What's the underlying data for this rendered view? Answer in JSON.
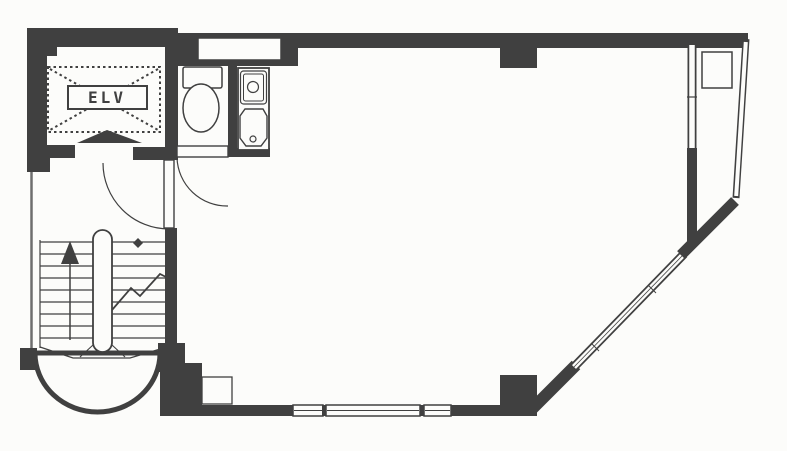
{
  "title": "Building floor plan",
  "labels": {
    "elevator": "ELV"
  },
  "colors": {
    "wall": "#404040",
    "mid": "#6e6e6e",
    "white": "#fcfcfa",
    "none": "none"
  },
  "canvas": {
    "width": 787,
    "height": 451
  },
  "shapes": [
    {
      "t": "path",
      "n": "stair-bay-wall",
      "d": "M35,353 A62.5,59 0 0 0 160,353 Z",
      "f": "white",
      "s": "wall",
      "sw": 5
    },
    {
      "t": "line",
      "n": "left-exterior-wall",
      "x1": 31.5,
      "y1": 150,
      "x2": 31.5,
      "y2": 352,
      "s": "mid",
      "sw": 2.5
    },
    {
      "t": "rect",
      "n": "top-wall-elevator",
      "x": 27,
      "y": 28,
      "w": 151,
      "h": 19,
      "f": "wall"
    },
    {
      "t": "rect",
      "n": "top-wall-main",
      "x": 178,
      "y": 33,
      "w": 570,
      "h": 15,
      "f": "wall"
    },
    {
      "t": "rect",
      "n": "wc-ceiling-wall",
      "x": 175,
      "y": 33,
      "w": 123,
      "h": 33,
      "f": "wall"
    },
    {
      "t": "rect",
      "n": "top-window",
      "x": 198,
      "y": 38,
      "w": 83,
      "h": 22,
      "f": "white",
      "s": "wall",
      "sw": 1.5
    },
    {
      "t": "rect",
      "n": "top-wall-column",
      "x": 500,
      "y": 47,
      "w": 37,
      "h": 21,
      "f": "wall"
    },
    {
      "t": "rect",
      "n": "left-wall-upper",
      "x": 27,
      "y": 28,
      "w": 20,
      "h": 122,
      "f": "wall"
    },
    {
      "t": "rect",
      "n": "elevator-wall-notch",
      "x": 45,
      "y": 42,
      "w": 12,
      "h": 14,
      "f": "wall"
    },
    {
      "t": "rect",
      "n": "left-wall-corner-block",
      "x": 27,
      "y": 145,
      "w": 23,
      "h": 27,
      "f": "wall"
    },
    {
      "t": "rect",
      "n": "lobby-wall-left",
      "x": 47,
      "y": 145,
      "w": 28,
      "h": 13,
      "f": "wall"
    },
    {
      "t": "rect",
      "n": "lobby-wall-right",
      "x": 133,
      "y": 147,
      "w": 45,
      "h": 13,
      "f": "wall"
    },
    {
      "t": "rect",
      "n": "elevator-east-wall",
      "x": 165,
      "y": 33,
      "w": 13,
      "h": 116,
      "f": "wall"
    },
    {
      "t": "rect",
      "n": "wc-sink-divider-wall",
      "x": 228,
      "y": 66,
      "w": 9,
      "h": 85,
      "f": "wall"
    },
    {
      "t": "rect",
      "n": "under-sink-wall",
      "x": 228,
      "y": 148,
      "w": 42,
      "h": 9,
      "f": "wall"
    },
    {
      "t": "rect",
      "n": "stairwell-east-wall",
      "x": 165,
      "y": 228,
      "w": 12,
      "h": 137,
      "f": "wall"
    },
    {
      "t": "rect",
      "n": "stairwell-shoulder-block",
      "x": 158,
      "y": 343,
      "w": 27,
      "h": 29,
      "f": "wall"
    },
    {
      "t": "rect",
      "n": "southwest-corner-wall",
      "x": 160,
      "y": 363,
      "w": 42,
      "h": 53,
      "f": "wall"
    },
    {
      "t": "rect",
      "n": "stair-bay-left-block",
      "x": 20,
      "y": 348,
      "w": 17,
      "h": 22,
      "f": "wall"
    },
    {
      "t": "rect",
      "n": "south-wall-west",
      "x": 200,
      "y": 405,
      "w": 93,
      "h": 11,
      "f": "wall"
    },
    {
      "t": "rect",
      "n": "south-wall-pilaster",
      "x": 202,
      "y": 377,
      "w": 30,
      "h": 27,
      "f": "white",
      "s": "wall",
      "sw": 1.3
    },
    {
      "t": "rect",
      "n": "south-window-1",
      "x": 293,
      "y": 405,
      "w": 30,
      "h": 11,
      "f": "white",
      "s": "wall",
      "sw": 1.5
    },
    {
      "t": "line",
      "n": "south-window-1-mullion",
      "x1": 294,
      "y1": 410.5,
      "x2": 322,
      "y2": 410.5,
      "s": "wall",
      "sw": 1
    },
    {
      "t": "rect",
      "n": "south-window-gap-1",
      "x": 322,
      "y": 405,
      "w": 4,
      "h": 11,
      "f": "wall"
    },
    {
      "t": "rect",
      "n": "south-window-2",
      "x": 326,
      "y": 405,
      "w": 94,
      "h": 11,
      "f": "white",
      "s": "wall",
      "sw": 1.5
    },
    {
      "t": "line",
      "n": "south-window-2-mullion",
      "x1": 327,
      "y1": 410.5,
      "x2": 419,
      "y2": 410.5,
      "s": "wall",
      "sw": 1
    },
    {
      "t": "rect",
      "n": "south-window-gap-2",
      "x": 420,
      "y": 405,
      "w": 4,
      "h": 11,
      "f": "wall"
    },
    {
      "t": "rect",
      "n": "south-window-3",
      "x": 424,
      "y": 405,
      "w": 27,
      "h": 11,
      "f": "white",
      "s": "wall",
      "sw": 1.5
    },
    {
      "t": "line",
      "n": "south-window-3-mullion",
      "x1": 425,
      "y1": 410.5,
      "x2": 450,
      "y2": 410.5,
      "s": "wall",
      "sw": 1
    },
    {
      "t": "rect",
      "n": "south-wall-east",
      "x": 451,
      "y": 405,
      "w": 49,
      "h": 11,
      "f": "wall"
    },
    {
      "t": "rect",
      "n": "southeast-column",
      "x": 500,
      "y": 375,
      "w": 37,
      "h": 41,
      "f": "wall"
    },
    {
      "t": "line",
      "n": "diagonal-wall-lower",
      "x1": 532,
      "y1": 409,
      "x2": 576,
      "y2": 365,
      "s": "wall",
      "sw": 12
    },
    {
      "t": "line",
      "n": "diagonal-window-casing",
      "x1": 572,
      "y1": 369,
      "x2": 684,
      "y2": 254,
      "s": "wall",
      "sw": 9
    },
    {
      "t": "line",
      "n": "diagonal-window-glass",
      "x1": 574,
      "y1": 367,
      "x2": 682,
      "y2": 256,
      "s": "white",
      "sw": 5.5
    },
    {
      "t": "line",
      "n": "diagonal-window-mullion",
      "x1": 574,
      "y1": 367,
      "x2": 682,
      "y2": 256,
      "s": "wall",
      "sw": 0.8
    },
    {
      "t": "line",
      "n": "diagonal-window-tick-1",
      "x1": 648,
      "y1": 285,
      "x2": 656,
      "y2": 293,
      "s": "wall",
      "sw": 1
    },
    {
      "t": "line",
      "n": "diagonal-window-tick-2",
      "x1": 591,
      "y1": 343,
      "x2": 599,
      "y2": 351,
      "s": "wall",
      "sw": 1
    },
    {
      "t": "line",
      "n": "diagonal-wall-upper",
      "x1": 681,
      "y1": 255,
      "x2": 735,
      "y2": 201,
      "s": "wall",
      "sw": 11
    },
    {
      "t": "line",
      "n": "east-window-casing",
      "x1": 692,
      "y1": 42,
      "x2": 692,
      "y2": 150,
      "s": "wall",
      "sw": 9
    },
    {
      "t": "line",
      "n": "east-window-glass",
      "x1": 692,
      "y1": 45,
      "x2": 692,
      "y2": 148,
      "s": "white",
      "sw": 5.5
    },
    {
      "t": "line",
      "n": "east-window-tick",
      "x1": 687,
      "y1": 97,
      "x2": 697,
      "y2": 97,
      "s": "wall",
      "sw": 1.2
    },
    {
      "t": "rect",
      "n": "east-wall-lower",
      "x": 687,
      "y": 148,
      "w": 10,
      "h": 96,
      "f": "wall"
    },
    {
      "t": "line",
      "n": "balcony-outer-wall-casing",
      "x1": 746,
      "y1": 39,
      "x2": 736,
      "y2": 198,
      "s": "wall",
      "sw": 7
    },
    {
      "t": "line",
      "n": "balcony-outer-wall-glass",
      "x1": 745.8,
      "y1": 42,
      "x2": 736.2,
      "y2": 196,
      "s": "white",
      "sw": 4
    },
    {
      "t": "rect",
      "n": "balcony-unit",
      "x": 702,
      "y": 52,
      "w": 30,
      "h": 36,
      "f": "white",
      "s": "wall",
      "sw": 1.5
    },
    {
      "t": "line",
      "n": "elevator-cross-diag-1",
      "x1": 50,
      "y1": 69,
      "x2": 158,
      "y2": 130,
      "s": "wall",
      "sw": 2,
      "da": "2.5,3"
    },
    {
      "t": "line",
      "n": "elevator-cross-diag-2",
      "x1": 158,
      "y1": 69,
      "x2": 50,
      "y2": 130,
      "s": "wall",
      "sw": 2,
      "da": "2.5,3"
    },
    {
      "t": "rect",
      "n": "elevator-dashed-outline",
      "x": 48,
      "y": 67,
      "w": 112,
      "h": 65,
      "f": "none",
      "s": "wall",
      "sw": 2,
      "da": "2.5,3"
    },
    {
      "t": "rect",
      "n": "elevator-label-box",
      "x": 68,
      "y": 86,
      "w": 79,
      "h": 23,
      "f": "white",
      "s": "wall",
      "sw": 2
    },
    {
      "t": "text",
      "n": "elevator-label",
      "x": 107,
      "y": 103,
      "bind": "labels.elevator",
      "size": 16,
      "anchor": "middle",
      "ls": 3,
      "weight": "bold"
    },
    {
      "t": "poly",
      "n": "elevator-door-marker",
      "pts": "107,130 77,143 142,143",
      "f": "wall"
    },
    {
      "t": "rect",
      "n": "hall-door-leaf",
      "x": 164,
      "y": 160,
      "w": 10,
      "h": 68,
      "f": "white",
      "s": "wall",
      "sw": 1.4
    },
    {
      "t": "path",
      "n": "hall-door-swing",
      "d": "M103,163 A66,66 0 0 0 169,229",
      "f": "none",
      "s": "wall",
      "sw": 1.2
    },
    {
      "t": "rect",
      "n": "wc-door-leaf",
      "x": 177,
      "y": 146,
      "w": 51,
      "h": 11,
      "f": "white",
      "s": "wall",
      "sw": 1.4
    },
    {
      "t": "path",
      "n": "wc-door-swing",
      "d": "M177,158 A50,50 0 0 0 228,206",
      "f": "none",
      "s": "wall",
      "sw": 1.2
    },
    {
      "t": "rect",
      "n": "toilet-tank",
      "x": 183,
      "y": 67,
      "w": 39,
      "h": 21,
      "rx": 2,
      "f": "white",
      "s": "wall",
      "sw": 1.5
    },
    {
      "t": "ellipse",
      "n": "toilet-bowl",
      "cx": 201,
      "cy": 108,
      "rx": 18,
      "ry": 24,
      "f": "white",
      "s": "wall",
      "sw": 1.5
    },
    {
      "t": "rect",
      "n": "sink-cabinet",
      "x": 238,
      "y": 68,
      "w": 31,
      "h": 82,
      "f": "white",
      "s": "wall",
      "sw": 1.8
    },
    {
      "t": "rect",
      "n": "sink-basin-upper",
      "x": 240.5,
      "y": 71,
      "w": 26,
      "h": 33,
      "rx": 3,
      "f": "none",
      "s": "wall",
      "sw": 1.2
    },
    {
      "t": "rect",
      "n": "sink-basin-upper-inner",
      "x": 243.5,
      "y": 74,
      "w": 20,
      "h": 27,
      "rx": 2,
      "f": "none",
      "s": "wall",
      "sw": 1
    },
    {
      "t": "circle",
      "n": "sink-drain-upper",
      "cx": 253,
      "cy": 87,
      "r": 5.5,
      "f": "white",
      "s": "wall",
      "sw": 1.2
    },
    {
      "t": "poly",
      "n": "sink-basin-lower",
      "pts": "245,109 263,109 267,116 267,138 261,146 246,146 240,138 240,116",
      "f": "none",
      "s": "wall",
      "sw": 1.4
    },
    {
      "t": "circle",
      "n": "sink-drain-lower",
      "cx": 253,
      "cy": 139,
      "r": 3,
      "f": "none",
      "s": "wall",
      "sw": 1.2
    },
    {
      "t": "line",
      "n": "stair-tread",
      "x1": 40,
      "y1": 242,
      "x2": 93,
      "y2": 242,
      "s": "wall",
      "sw": 1.2
    },
    {
      "t": "line",
      "n": "stair-tread",
      "x1": 40,
      "y1": 254,
      "x2": 93,
      "y2": 254,
      "s": "wall",
      "sw": 1.2
    },
    {
      "t": "line",
      "n": "stair-tread",
      "x1": 40,
      "y1": 266,
      "x2": 93,
      "y2": 266,
      "s": "wall",
      "sw": 1.2
    },
    {
      "t": "line",
      "n": "stair-tread",
      "x1": 40,
      "y1": 278,
      "x2": 93,
      "y2": 278,
      "s": "wall",
      "sw": 1.2
    },
    {
      "t": "line",
      "n": "stair-tread",
      "x1": 40,
      "y1": 290,
      "x2": 93,
      "y2": 290,
      "s": "wall",
      "sw": 1.2
    },
    {
      "t": "line",
      "n": "stair-tread",
      "x1": 40,
      "y1": 302,
      "x2": 93,
      "y2": 302,
      "s": "wall",
      "sw": 1.2
    },
    {
      "t": "line",
      "n": "stair-tread",
      "x1": 40,
      "y1": 314,
      "x2": 93,
      "y2": 314,
      "s": "wall",
      "sw": 1.2
    },
    {
      "t": "line",
      "n": "stair-tread",
      "x1": 40,
      "y1": 326,
      "x2": 93,
      "y2": 326,
      "s": "wall",
      "sw": 1.2
    },
    {
      "t": "line",
      "n": "stair-tread",
      "x1": 40,
      "y1": 338,
      "x2": 93,
      "y2": 338,
      "s": "wall",
      "sw": 1.2
    },
    {
      "t": "line",
      "n": "stair-tread",
      "x1": 112,
      "y1": 242,
      "x2": 166,
      "y2": 242,
      "s": "wall",
      "sw": 1.2
    },
    {
      "t": "line",
      "n": "stair-tread",
      "x1": 112,
      "y1": 254,
      "x2": 166,
      "y2": 254,
      "s": "wall",
      "sw": 1.2
    },
    {
      "t": "line",
      "n": "stair-tread",
      "x1": 112,
      "y1": 266,
      "x2": 166,
      "y2": 266,
      "s": "wall",
      "sw": 1.2
    },
    {
      "t": "line",
      "n": "stair-tread",
      "x1": 112,
      "y1": 278,
      "x2": 166,
      "y2": 278,
      "s": "wall",
      "sw": 1.2
    },
    {
      "t": "line",
      "n": "stair-tread",
      "x1": 112,
      "y1": 290,
      "x2": 166,
      "y2": 290,
      "s": "wall",
      "sw": 1.2
    },
    {
      "t": "line",
      "n": "stair-tread",
      "x1": 112,
      "y1": 302,
      "x2": 166,
      "y2": 302,
      "s": "wall",
      "sw": 1.2
    },
    {
      "t": "line",
      "n": "stair-tread",
      "x1": 112,
      "y1": 314,
      "x2": 166,
      "y2": 314,
      "s": "wall",
      "sw": 1.2
    },
    {
      "t": "line",
      "n": "stair-tread",
      "x1": 112,
      "y1": 326,
      "x2": 166,
      "y2": 326,
      "s": "wall",
      "sw": 1.2
    },
    {
      "t": "line",
      "n": "stair-tread",
      "x1": 112,
      "y1": 338,
      "x2": 166,
      "y2": 338,
      "s": "wall",
      "sw": 1.2
    },
    {
      "t": "line",
      "n": "stair-left-edge",
      "x1": 40,
      "y1": 240,
      "x2": 40,
      "y2": 348,
      "s": "wall",
      "sw": 1.2
    },
    {
      "t": "poly",
      "n": "stair-winder-edge",
      "pts": "40,347 73,358 130,358 167,347",
      "open": true,
      "f": "none",
      "s": "wall",
      "sw": 1.2
    },
    {
      "t": "line",
      "n": "stair-winder-left",
      "x1": 93,
      "y1": 345,
      "x2": 80,
      "y2": 357,
      "s": "wall",
      "sw": 1.1
    },
    {
      "t": "line",
      "n": "stair-winder-right",
      "x1": 112,
      "y1": 345,
      "x2": 125,
      "y2": 357,
      "s": "wall",
      "sw": 1.1
    },
    {
      "t": "rect",
      "n": "stair-divider",
      "x": 93,
      "y": 230,
      "w": 19,
      "h": 122,
      "rx": 9.5,
      "f": "white",
      "s": "wall",
      "sw": 1.8
    },
    {
      "t": "line",
      "n": "stair-arrow-shaft",
      "x1": 70,
      "y1": 340,
      "x2": 70,
      "y2": 262,
      "s": "wall",
      "sw": 1.5
    },
    {
      "t": "poly",
      "n": "stair-arrow-head",
      "pts": "70,241 61,264 79,264",
      "f": "wall"
    },
    {
      "t": "poly",
      "n": "stair-newel-diamond",
      "pts": "138,238 143,243 138,248 133,243",
      "f": "wall"
    },
    {
      "t": "poly",
      "n": "stair-break-line",
      "pts": "112,310 131,288 140,296 160,274 166,277",
      "open": true,
      "f": "none",
      "s": "wall",
      "sw": 1.8
    }
  ]
}
